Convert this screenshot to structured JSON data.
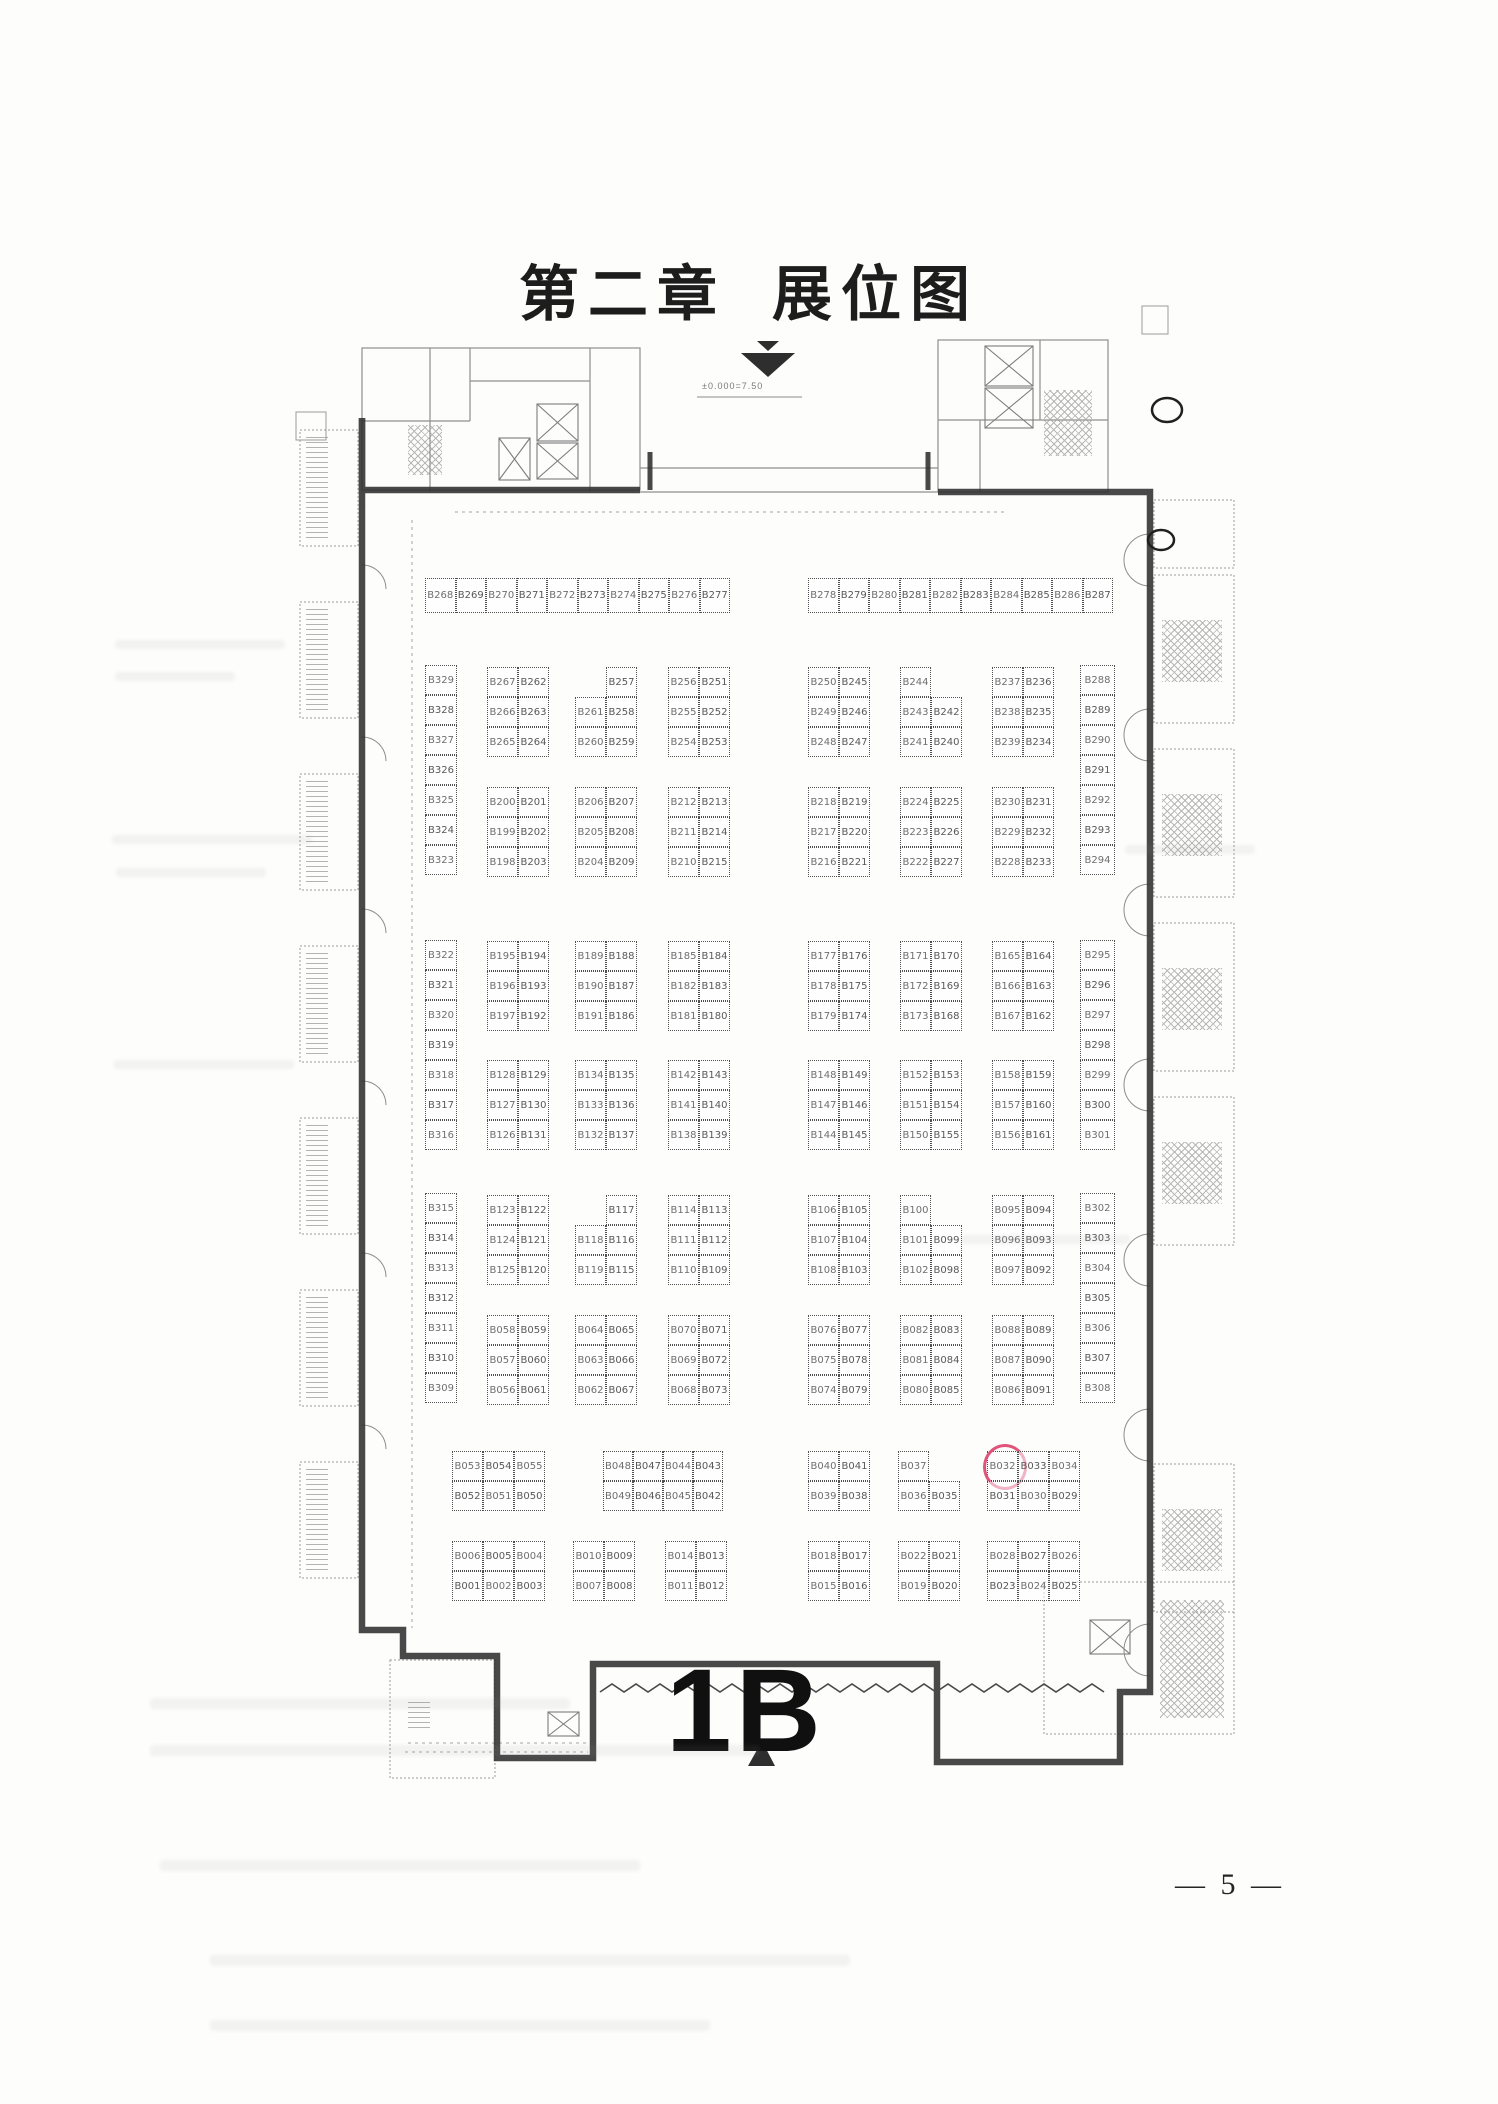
{
  "page": {
    "title_chapter": "第二章",
    "title_name": "展位图",
    "hall_label": "1B",
    "elevation_note": "±0.000=7.50",
    "page_number": "— 5 —"
  },
  "plan": {
    "highlight": {
      "booth": "B032",
      "color": "#e0547a"
    },
    "blocks": [
      {
        "x": 425,
        "y": 578,
        "cw": 30.5,
        "ch": 35,
        "rows": [
          [
            "B268",
            "B269",
            "B270",
            "B271",
            "B272",
            "B273",
            "B274",
            "B275",
            "B276",
            "B277"
          ]
        ]
      },
      {
        "x": 808,
        "y": 578,
        "cw": 30.5,
        "ch": 35,
        "rows": [
          [
            "B278",
            "B279",
            "B280",
            "B281",
            "B282",
            "B283",
            "B284",
            "B285",
            "B286",
            "B287"
          ]
        ]
      },
      {
        "x": 425,
        "y": 665,
        "cw": 32,
        "rows": [
          [
            "B329"
          ],
          [
            "B328"
          ],
          [
            "B327"
          ],
          [
            "B326"
          ],
          [
            "B325"
          ],
          [
            "B324"
          ],
          [
            "B323"
          ]
        ]
      },
      {
        "x": 425,
        "y": 940,
        "cw": 32,
        "rows": [
          [
            "B322"
          ],
          [
            "B321"
          ],
          [
            "B320"
          ],
          [
            "B319"
          ],
          [
            "B318"
          ],
          [
            "B317"
          ],
          [
            "B316"
          ]
        ]
      },
      {
        "x": 425,
        "y": 1193,
        "cw": 32,
        "rows": [
          [
            "B315"
          ],
          [
            "B314"
          ],
          [
            "B313"
          ],
          [
            "B312"
          ],
          [
            "B311"
          ],
          [
            "B310"
          ],
          [
            "B309"
          ]
        ]
      },
      {
        "x": 1080,
        "y": 665,
        "cw": 35,
        "rows": [
          [
            "B288"
          ],
          [
            "B289"
          ],
          [
            "B290"
          ],
          [
            "B291"
          ],
          [
            "B292"
          ],
          [
            "B293"
          ],
          [
            "B294"
          ]
        ]
      },
      {
        "x": 1080,
        "y": 940,
        "cw": 35,
        "rows": [
          [
            "B295"
          ],
          [
            "B296"
          ],
          [
            "B297"
          ],
          [
            "B298"
          ],
          [
            "B299"
          ],
          [
            "B300"
          ],
          [
            "B301"
          ]
        ]
      },
      {
        "x": 1080,
        "y": 1193,
        "cw": 35,
        "rows": [
          [
            "B302"
          ],
          [
            "B303"
          ],
          [
            "B304"
          ],
          [
            "B305"
          ],
          [
            "B306"
          ],
          [
            "B307"
          ],
          [
            "B308"
          ]
        ]
      },
      {
        "x": 487,
        "y": 667,
        "rows": [
          [
            "B267",
            "B262"
          ],
          [
            "B266",
            "B263"
          ],
          [
            "B265",
            "B264"
          ]
        ]
      },
      {
        "x": 575,
        "y": 667,
        "rows": [
          [
            null,
            "B257"
          ],
          [
            "B261",
            "B258"
          ],
          [
            "B260",
            "B259"
          ]
        ]
      },
      {
        "x": 668,
        "y": 667,
        "rows": [
          [
            "B256",
            "B251"
          ],
          [
            "B255",
            "B252"
          ],
          [
            "B254",
            "B253"
          ]
        ]
      },
      {
        "x": 808,
        "y": 667,
        "rows": [
          [
            "B250",
            "B245"
          ],
          [
            "B249",
            "B246"
          ],
          [
            "B248",
            "B247"
          ]
        ]
      },
      {
        "x": 900,
        "y": 667,
        "rows": [
          [
            "B244",
            null
          ],
          [
            "B243",
            "B242"
          ],
          [
            "B241",
            "B240"
          ]
        ]
      },
      {
        "x": 992,
        "y": 667,
        "rows": [
          [
            "B237",
            "B236"
          ],
          [
            "B238",
            "B235"
          ],
          [
            "B239",
            "B234"
          ]
        ]
      },
      {
        "x": 487,
        "y": 787,
        "rows": [
          [
            "B200",
            "B201"
          ],
          [
            "B199",
            "B202"
          ],
          [
            "B198",
            "B203"
          ]
        ]
      },
      {
        "x": 575,
        "y": 787,
        "rows": [
          [
            "B206",
            "B207"
          ],
          [
            "B205",
            "B208"
          ],
          [
            "B204",
            "B209"
          ]
        ]
      },
      {
        "x": 668,
        "y": 787,
        "rows": [
          [
            "B212",
            "B213"
          ],
          [
            "B211",
            "B214"
          ],
          [
            "B210",
            "B215"
          ]
        ]
      },
      {
        "x": 808,
        "y": 787,
        "rows": [
          [
            "B218",
            "B219"
          ],
          [
            "B217",
            "B220"
          ],
          [
            "B216",
            "B221"
          ]
        ]
      },
      {
        "x": 900,
        "y": 787,
        "rows": [
          [
            "B224",
            "B225"
          ],
          [
            "B223",
            "B226"
          ],
          [
            "B222",
            "B227"
          ]
        ]
      },
      {
        "x": 992,
        "y": 787,
        "rows": [
          [
            "B230",
            "B231"
          ],
          [
            "B229",
            "B232"
          ],
          [
            "B228",
            "B233"
          ]
        ]
      },
      {
        "x": 487,
        "y": 941,
        "rows": [
          [
            "B195",
            "B194"
          ],
          [
            "B196",
            "B193"
          ],
          [
            "B197",
            "B192"
          ]
        ]
      },
      {
        "x": 575,
        "y": 941,
        "rows": [
          [
            "B189",
            "B188"
          ],
          [
            "B190",
            "B187"
          ],
          [
            "B191",
            "B186"
          ]
        ]
      },
      {
        "x": 668,
        "y": 941,
        "rows": [
          [
            "B185",
            "B184"
          ],
          [
            "B182",
            "B183"
          ],
          [
            "B181",
            "B180"
          ]
        ]
      },
      {
        "x": 808,
        "y": 941,
        "rows": [
          [
            "B177",
            "B176"
          ],
          [
            "B178",
            "B175"
          ],
          [
            "B179",
            "B174"
          ]
        ]
      },
      {
        "x": 900,
        "y": 941,
        "rows": [
          [
            "B171",
            "B170"
          ],
          [
            "B172",
            "B169"
          ],
          [
            "B173",
            "B168"
          ]
        ]
      },
      {
        "x": 992,
        "y": 941,
        "rows": [
          [
            "B165",
            "B164"
          ],
          [
            "B166",
            "B163"
          ],
          [
            "B167",
            "B162"
          ]
        ]
      },
      {
        "x": 487,
        "y": 1060,
        "rows": [
          [
            "B128",
            "B129"
          ],
          [
            "B127",
            "B130"
          ],
          [
            "B126",
            "B131"
          ]
        ]
      },
      {
        "x": 575,
        "y": 1060,
        "rows": [
          [
            "B134",
            "B135"
          ],
          [
            "B133",
            "B136"
          ],
          [
            "B132",
            "B137"
          ]
        ]
      },
      {
        "x": 668,
        "y": 1060,
        "rows": [
          [
            "B142",
            "B143"
          ],
          [
            "B141",
            "B140"
          ],
          [
            "B138",
            "B139"
          ]
        ]
      },
      {
        "x": 808,
        "y": 1060,
        "rows": [
          [
            "B148",
            "B149"
          ],
          [
            "B147",
            "B146"
          ],
          [
            "B144",
            "B145"
          ]
        ]
      },
      {
        "x": 900,
        "y": 1060,
        "rows": [
          [
            "B152",
            "B153"
          ],
          [
            "B151",
            "B154"
          ],
          [
            "B150",
            "B155"
          ]
        ]
      },
      {
        "x": 992,
        "y": 1060,
        "rows": [
          [
            "B158",
            "B159"
          ],
          [
            "B157",
            "B160"
          ],
          [
            "B156",
            "B161"
          ]
        ]
      },
      {
        "x": 487,
        "y": 1195,
        "rows": [
          [
            "B123",
            "B122"
          ],
          [
            "B124",
            "B121"
          ],
          [
            "B125",
            "B120"
          ]
        ]
      },
      {
        "x": 575,
        "y": 1195,
        "rows": [
          [
            null,
            "B117"
          ],
          [
            "B118",
            "B116"
          ],
          [
            "B119",
            "B115"
          ]
        ]
      },
      {
        "x": 668,
        "y": 1195,
        "rows": [
          [
            "B114",
            "B113"
          ],
          [
            "B111",
            "B112"
          ],
          [
            "B110",
            "B109"
          ]
        ]
      },
      {
        "x": 808,
        "y": 1195,
        "rows": [
          [
            "B106",
            "B105"
          ],
          [
            "B107",
            "B104"
          ],
          [
            "B108",
            "B103"
          ]
        ]
      },
      {
        "x": 900,
        "y": 1195,
        "rows": [
          [
            "B100",
            null
          ],
          [
            "B101",
            "B099"
          ],
          [
            "B102",
            "B098"
          ]
        ]
      },
      {
        "x": 992,
        "y": 1195,
        "rows": [
          [
            "B095",
            "B094"
          ],
          [
            "B096",
            "B093"
          ],
          [
            "B097",
            "B092"
          ]
        ]
      },
      {
        "x": 487,
        "y": 1315,
        "rows": [
          [
            "B058",
            "B059"
          ],
          [
            "B057",
            "B060"
          ],
          [
            "B056",
            "B061"
          ]
        ]
      },
      {
        "x": 575,
        "y": 1315,
        "rows": [
          [
            "B064",
            "B065"
          ],
          [
            "B063",
            "B066"
          ],
          [
            "B062",
            "B067"
          ]
        ]
      },
      {
        "x": 668,
        "y": 1315,
        "rows": [
          [
            "B070",
            "B071"
          ],
          [
            "B069",
            "B072"
          ],
          [
            "B068",
            "B073"
          ]
        ]
      },
      {
        "x": 808,
        "y": 1315,
        "rows": [
          [
            "B076",
            "B077"
          ],
          [
            "B075",
            "B078"
          ],
          [
            "B074",
            "B079"
          ]
        ]
      },
      {
        "x": 900,
        "y": 1315,
        "rows": [
          [
            "B082",
            "B083"
          ],
          [
            "B081",
            "B084"
          ],
          [
            "B080",
            "B085"
          ]
        ]
      },
      {
        "x": 992,
        "y": 1315,
        "rows": [
          [
            "B088",
            "B089"
          ],
          [
            "B087",
            "B090"
          ],
          [
            "B086",
            "B091"
          ]
        ]
      },
      {
        "x": 452,
        "y": 1451,
        "rows": [
          [
            "B053",
            "B054",
            "B055"
          ],
          [
            "B052",
            "B051",
            "B050"
          ]
        ]
      },
      {
        "x": 603,
        "y": 1451,
        "cw": 30,
        "rows": [
          [
            "B048",
            "B047",
            "B044",
            "B043"
          ],
          [
            "B049",
            "B046",
            "B045",
            "B042"
          ]
        ]
      },
      {
        "x": 808,
        "y": 1451,
        "rows": [
          [
            "B040",
            "B041"
          ],
          [
            "B039",
            "B038"
          ]
        ]
      },
      {
        "x": 898,
        "y": 1451,
        "rows": [
          [
            "B037",
            null
          ],
          [
            "B036",
            "B035"
          ]
        ]
      },
      {
        "x": 987,
        "y": 1451,
        "rows": [
          [
            "B032",
            "B033",
            "B034"
          ],
          [
            "B031",
            "B030",
            "B029"
          ]
        ]
      },
      {
        "x": 452,
        "y": 1541,
        "rows": [
          [
            "B006",
            "B005",
            "B004"
          ],
          [
            "B001",
            "B002",
            "B003"
          ]
        ]
      },
      {
        "x": 573,
        "y": 1541,
        "rows": [
          [
            "B010",
            "B009"
          ],
          [
            "B007",
            "B008"
          ]
        ]
      },
      {
        "x": 665,
        "y": 1541,
        "rows": [
          [
            "B014",
            "B013"
          ],
          [
            "B011",
            "B012"
          ]
        ]
      },
      {
        "x": 808,
        "y": 1541,
        "rows": [
          [
            "B018",
            "B017"
          ],
          [
            "B015",
            "B016"
          ]
        ]
      },
      {
        "x": 898,
        "y": 1541,
        "rows": [
          [
            "B022",
            "B021"
          ],
          [
            "B019",
            "B020"
          ]
        ]
      },
      {
        "x": 987,
        "y": 1541,
        "rows": [
          [
            "B028",
            "B027",
            "B026"
          ],
          [
            "B023",
            "B024",
            "B025"
          ]
        ]
      }
    ]
  }
}
